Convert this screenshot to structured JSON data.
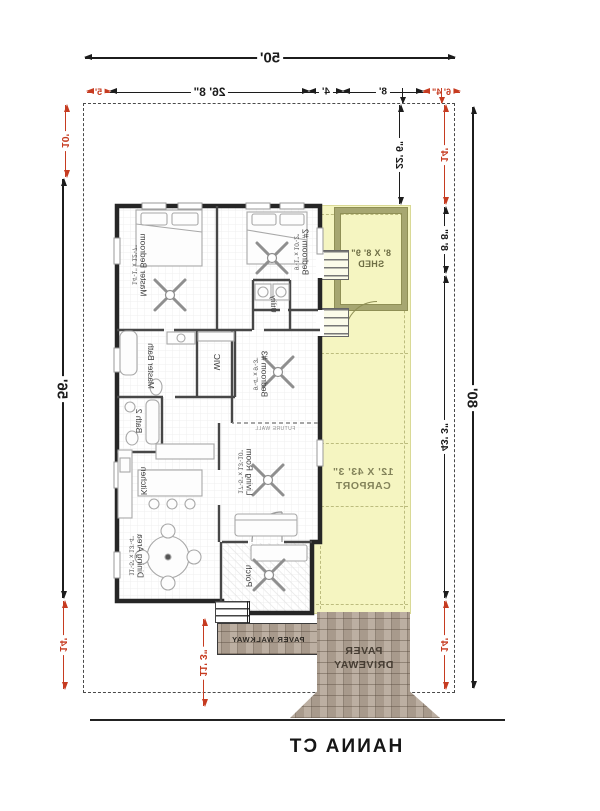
{
  "street": {
    "name": "HANNA CT"
  },
  "dims": {
    "lot_width": "50'",
    "top_row": {
      "seg_red_left": "6' 4\"",
      "seg_8": "8'",
      "seg_4": "4'",
      "seg_26_8": "26' 8\"",
      "seg_red_right": "5'"
    },
    "left_side": {
      "front_setback": "22' 6\"",
      "red_top": "14'",
      "shed_depth": "8' 8\"",
      "carport_length": "43' 3\"",
      "red_bottom": "14'",
      "lot_depth": "80'"
    },
    "right_side": {
      "red_top": "10'",
      "house_depth": "56'",
      "red_bottom": "14'"
    },
    "walkway_length": "11' 3\""
  },
  "plan": {
    "rooms": {
      "master_bedroom": {
        "name": "Master Bedroom",
        "size": "14'-1\" x 12'-7\""
      },
      "bedroom2": {
        "name": "Bedroom #2",
        "size": "9'-1\" x 10'-2\""
      },
      "bedroom3": {
        "name": "Bedroom #3",
        "size": "9'-4\" x 9'-3\""
      },
      "living_room": {
        "name": "Living Room",
        "size": "17'-5\" x 13'-10\""
      },
      "kitchen": {
        "name": "Kitchen",
        "size": ""
      },
      "dining": {
        "name": "Dining Area",
        "size": "11'-5\" x 13'-4\""
      },
      "master_bath": {
        "name": "Master Bath",
        "size": ""
      },
      "bath2": {
        "name": "Bath 2",
        "size": ""
      },
      "wic": {
        "name": "WIC",
        "size": ""
      },
      "utility": {
        "name": "Utility",
        "size": ""
      },
      "porch": {
        "name": "Porch",
        "size": ""
      }
    },
    "future_wall": "FUTURE WALL",
    "shed": {
      "size": "8' X 8' 9\"",
      "name": "SHED"
    },
    "carport": {
      "size": "12' X 43' 3\"",
      "name": "CARPORT"
    },
    "walkway_label": "PAVER WALKWAY",
    "driveway_label_line1": "PAVER",
    "driveway_label_line2": "DRIVEWAY"
  },
  "colors": {
    "dimension_red": "#c63b20",
    "dimension_black": "#1c1c1c",
    "carport_fill": "#f5f5c1",
    "shed_wall": "#a6a671",
    "paver_base": "#b4a697",
    "paver_joint": "#50423 6"
  }
}
